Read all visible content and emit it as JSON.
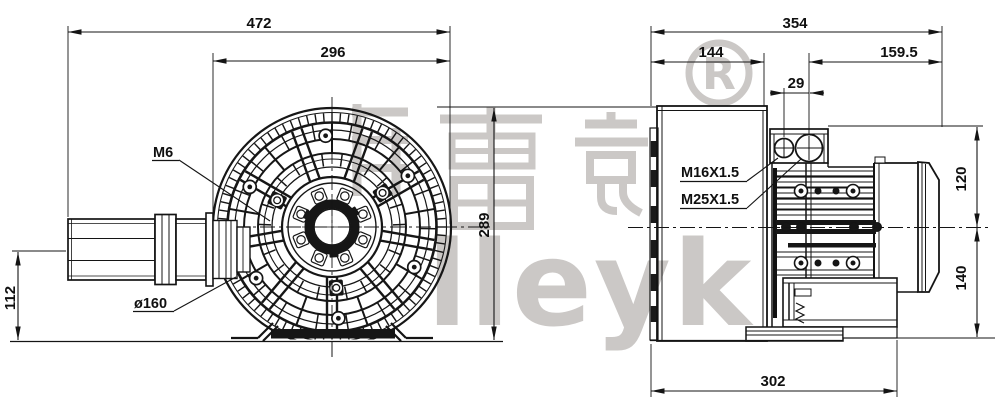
{
  "drawing": {
    "front_view": {
      "dim_overall_width": "472",
      "dim_housing_width": "296",
      "dim_overall_height": "289",
      "dim_muffler_axis_height": "112",
      "label_thread": "M6",
      "label_diameter": "ø160"
    },
    "side_view": {
      "dim_overall_length": "354",
      "dim_housing_length": "144",
      "dim_motor_length": "159.5",
      "dim_gland_spacing": "29",
      "dim_height_above_axis": "120",
      "dim_height_below_axis": "140",
      "dim_base_length": "302",
      "label_gland_small": "M16X1.5",
      "label_gland_large": "M25X1.5"
    },
    "watermark": {
      "registered_mark": "R",
      "text_cn": "雷克",
      "text_latin": "lleyk",
      "color": "#cbc8c6"
    }
  }
}
